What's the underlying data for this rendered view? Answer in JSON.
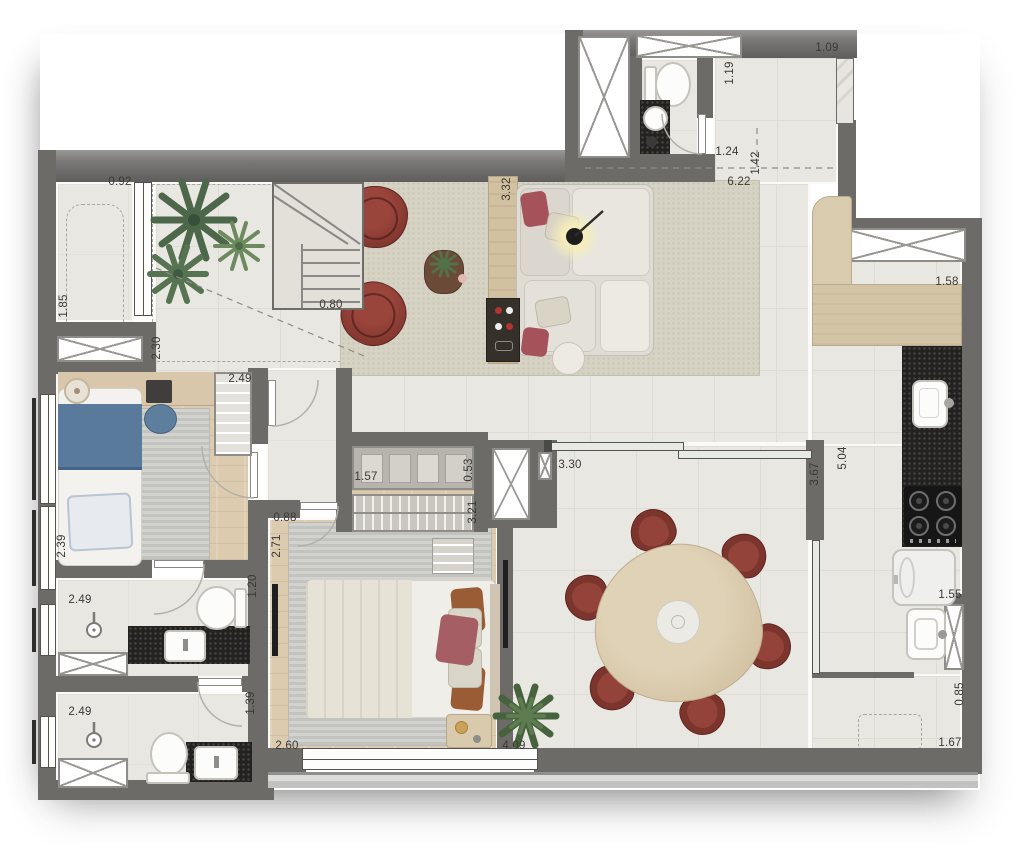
{
  "colors": {
    "wall": "#6d6b68",
    "floor_tile": "#e9e7e2",
    "wood_floor": "#ddcbb0",
    "area_rug": "#d7d3c4",
    "armchair_red": "#8a3a33",
    "counter_black": "#232220",
    "counter_wood": "#d4c4a6",
    "bed_blue": "#5a7a9c",
    "plant_green": "#4c6749",
    "glass": "#e7e9e4",
    "dimension_text": "#3b3936"
  },
  "icons": [
    "palm-plant-icon",
    "fern-plant-icon",
    "staircase-icon",
    "shower-head-icon",
    "toilet-icon",
    "sink-icon",
    "cooktop-icon",
    "washer-icon",
    "laundry-sink-icon",
    "sofa-icon",
    "armchair-icon",
    "floor-lamp-icon",
    "coffee-table-icon",
    "side-table-icon",
    "tv-icon",
    "dining-table-icon",
    "dining-chair-icon",
    "double-bed-icon",
    "single-bed-icon",
    "desk-icon",
    "desk-chair-icon",
    "wardrobe-icon",
    "closet-shelf-icon",
    "closet-hangers-icon",
    "dresser-icon",
    "nightstand-icon",
    "door-leaf-icon",
    "door-swing-icon",
    "window-icon",
    "duct-shaft-icon",
    "sliding-glass-door-icon",
    "entry-threshold-icon"
  ],
  "dimensions": [
    {
      "id": "terrace-opening-width",
      "value": "0.92"
    },
    {
      "id": "terrace-width",
      "value": "1.85"
    },
    {
      "id": "stair-zone-width",
      "value": "2.30"
    },
    {
      "id": "stair-width",
      "value": "0.80"
    },
    {
      "id": "bedroom2-width",
      "value": "2.49"
    },
    {
      "id": "living-console-span",
      "value": "3.32"
    },
    {
      "id": "lavabo-depth",
      "value": "1.19"
    },
    {
      "id": "lavabo-width",
      "value": "1.24"
    },
    {
      "id": "entry-door-width",
      "value": "1.09"
    },
    {
      "id": "entry-depth",
      "value": "1.42"
    },
    {
      "id": "living-entry-span",
      "value": "6.22"
    },
    {
      "id": "kitchen-counter-width",
      "value": "1.58"
    },
    {
      "id": "kitchen-length",
      "value": "5.04"
    },
    {
      "id": "dining-wall-height",
      "value": "3.67"
    },
    {
      "id": "sliding-door-width",
      "value": "3.30"
    },
    {
      "id": "laundry-niche-width",
      "value": "1.55"
    },
    {
      "id": "service-opening-width",
      "value": "0.85"
    },
    {
      "id": "service-width",
      "value": "1.67"
    },
    {
      "id": "terrace-span",
      "value": "4.09"
    },
    {
      "id": "bedroom2-depth",
      "value": "2.39"
    },
    {
      "id": "bath1-width",
      "value": "2.49"
    },
    {
      "id": "bath1-entry-depth",
      "value": "1.20"
    },
    {
      "id": "bath2-width",
      "value": "2.49"
    },
    {
      "id": "bath2-depth",
      "value": "1.39"
    },
    {
      "id": "master-window-width",
      "value": "2.60"
    },
    {
      "id": "master-door-width",
      "value": "0.88"
    },
    {
      "id": "master-entry-width",
      "value": "2.71"
    },
    {
      "id": "closet-shelf-width",
      "value": "1.57"
    },
    {
      "id": "closet-shelf-depth",
      "value": "0.53"
    },
    {
      "id": "closet-rail-width",
      "value": "3.21"
    }
  ]
}
